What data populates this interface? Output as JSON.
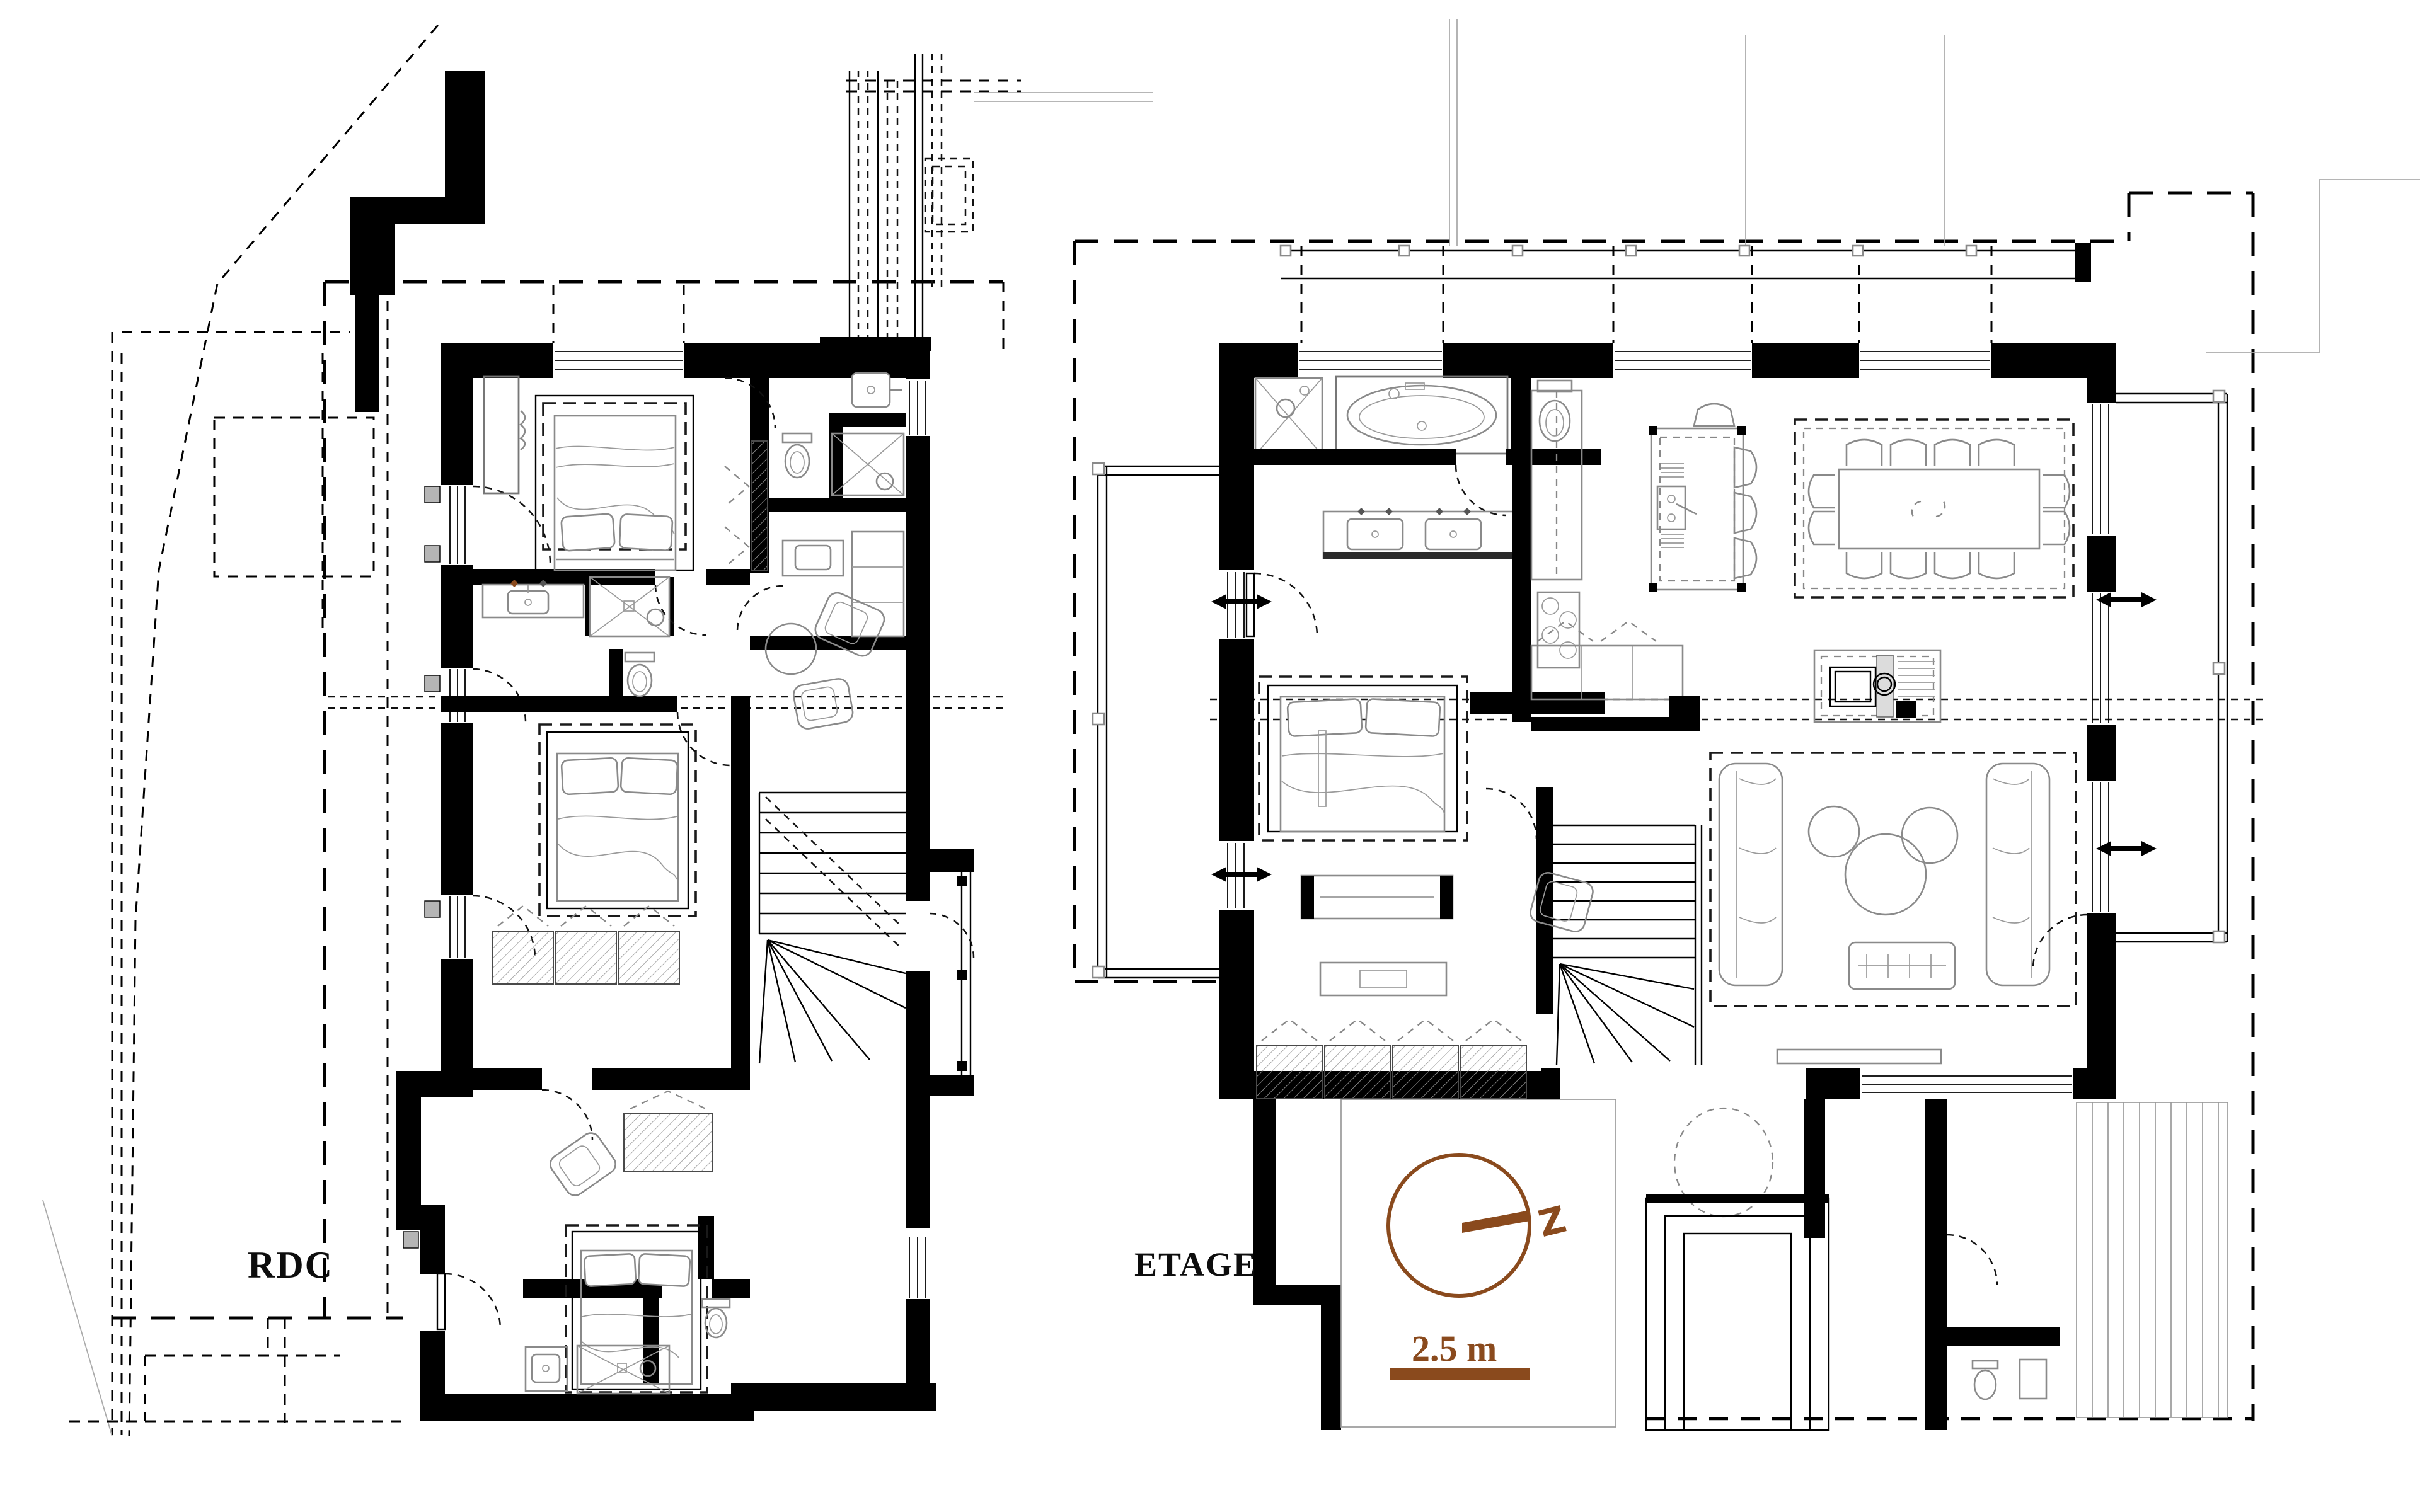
{
  "sheet": {
    "kind": "architectural floor plan drawing",
    "background": "#ffffff"
  },
  "labels": {
    "rdc": "RDC",
    "etage": "ETAGE"
  },
  "compass": {
    "letter": "Z",
    "icon": "compass-north-icon",
    "color": "#8A4A1D"
  },
  "scale_bar": {
    "label": "2.5 m",
    "color": "#8A4A1D"
  },
  "colors": {
    "walls": "#000000",
    "furniture_lines": "#8a8a8a",
    "accent_brown": "#8A4A1D",
    "sill_gray": "#b5b5b5",
    "dashed_lines": "#000000"
  },
  "plans": [
    {
      "id": "rdc",
      "label": "RDC",
      "rooms": [
        "bedroom-1",
        "bathroom-1",
        "bathroom-2",
        "bedroom-2",
        "sitting-area",
        "stair",
        "bedroom-3",
        "ensuite-3",
        "wc",
        "terrace"
      ]
    },
    {
      "id": "etage",
      "label": "ETAGE",
      "rooms": [
        "master-bathroom",
        "master-bedroom",
        "kitchen",
        "dining-area",
        "living-room",
        "stair",
        "balconies",
        "deck"
      ]
    }
  ]
}
